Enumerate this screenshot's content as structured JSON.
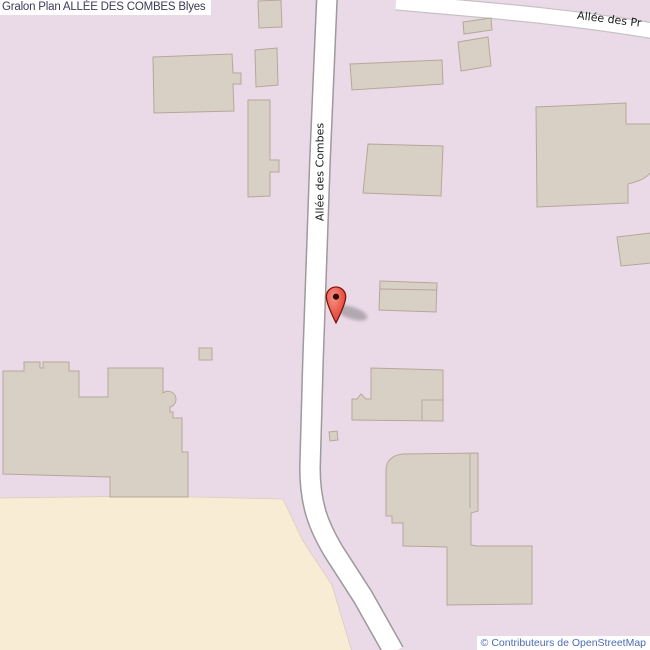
{
  "header": {
    "title": "Gralon Plan ALLÉE DES COMBES Blyes"
  },
  "map": {
    "labels": {
      "road_vertical": "Allée des Combes",
      "road_top_right": "Allée des Pr"
    },
    "attribution": "© Contributeurs de OpenStreetMap"
  },
  "colors": {
    "background": "#eadae7",
    "farmland": "#f8ecd4",
    "building_fill": "#d9d0c5",
    "building_stroke": "#b5a79a",
    "road_fill": "#ffffff",
    "road_casing": "#9d999c",
    "marker_red": "#e8564a",
    "title_text": "#3f3a56",
    "attribution_text": "#4b6cb5",
    "label_text": "#1c1c1c"
  }
}
